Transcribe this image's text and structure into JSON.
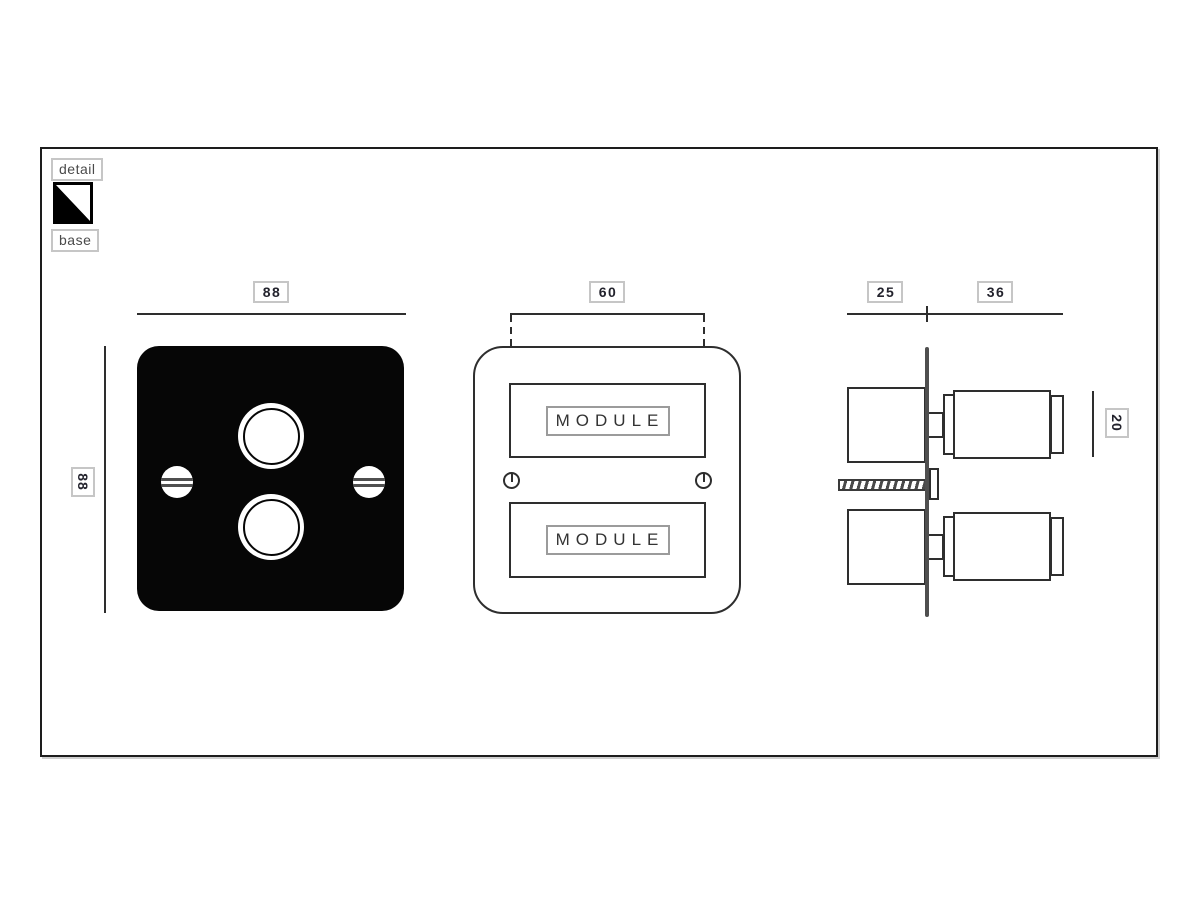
{
  "legend": {
    "detail": "detail",
    "base": "base"
  },
  "front_view": {
    "width_dim": "88",
    "height_dim": "88"
  },
  "module_view": {
    "width_dim": "60",
    "top_module": "MODULE",
    "bottom_module": "MODULE"
  },
  "side_view": {
    "depth_behind_dim": "25",
    "depth_front_dim": "36",
    "knob_dim": "20"
  },
  "colors": {
    "line": "#2e2e2e",
    "plate_fill": "#060606",
    "side_plate": "#4f4f4f",
    "label_border": "#c6c6c6",
    "label_text": "#23232d",
    "legend_text": "#4a4a4a",
    "module_tag_border": "#9b9b9b"
  }
}
